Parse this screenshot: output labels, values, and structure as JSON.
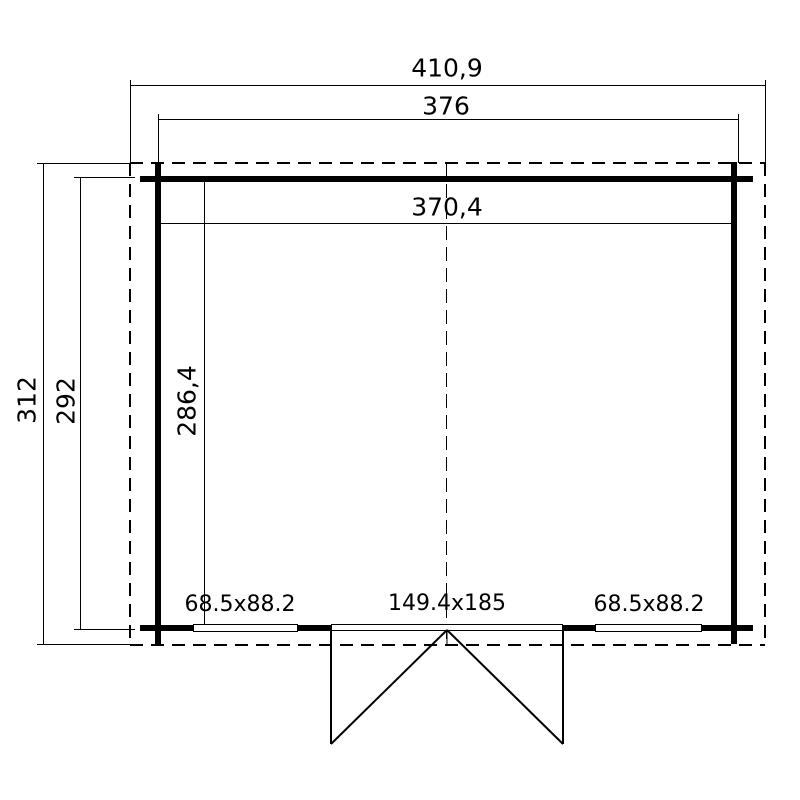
{
  "colors": {
    "line": "#000000",
    "background": "#ffffff"
  },
  "plan": {
    "dimensions": {
      "roof_width": "410,9",
      "wall_outer_width": "376",
      "interior_width": "370,4",
      "roof_depth": "312",
      "wall_outer_depth": "292",
      "interior_depth": "286,4"
    },
    "openings": {
      "left_window": "68.5x88.2",
      "door": "149.4x185",
      "right_window": "68.5x88.2"
    }
  }
}
